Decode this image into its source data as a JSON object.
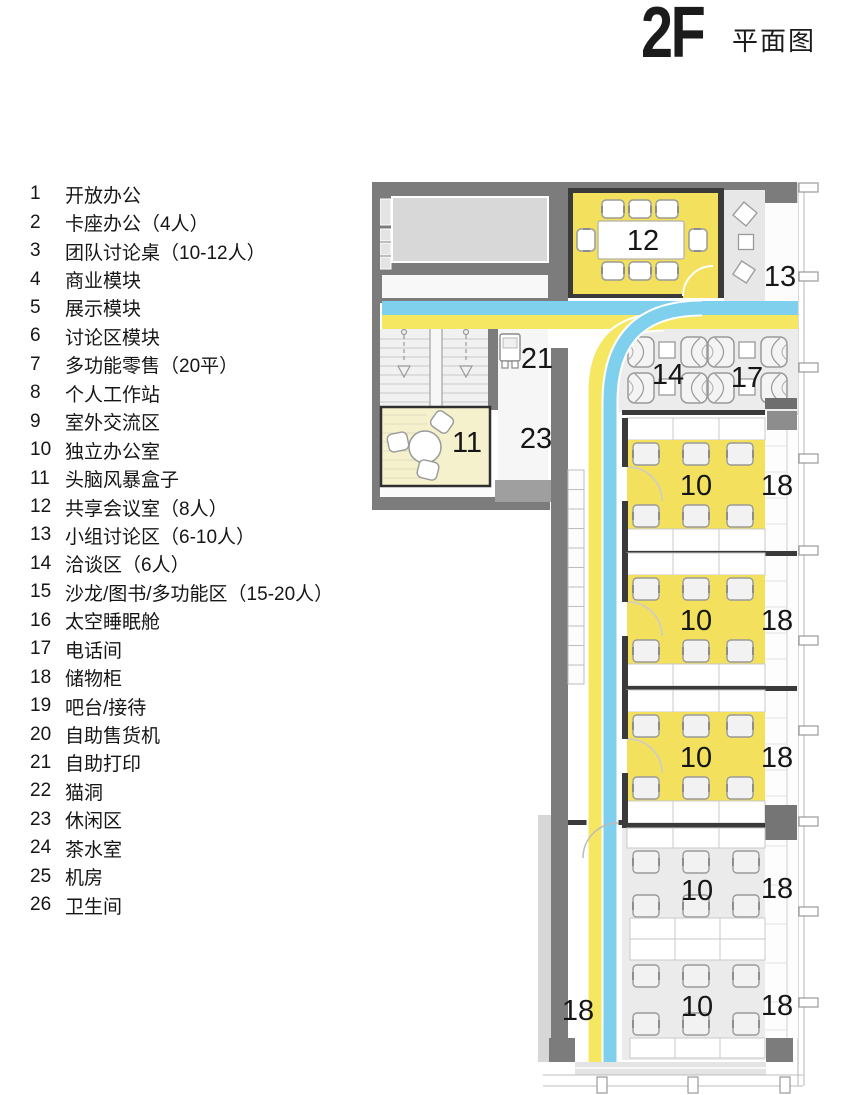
{
  "title": {
    "floor": "2F",
    "name": "平面图"
  },
  "legend": {
    "items": [
      {
        "num": "1",
        "label": "开放办公"
      },
      {
        "num": "2",
        "label": "卡座办公（4人）"
      },
      {
        "num": "3",
        "label": "团队讨论桌（10-12人）"
      },
      {
        "num": "4",
        "label": "商业模块"
      },
      {
        "num": "5",
        "label": "展示模块"
      },
      {
        "num": "6",
        "label": "讨论区模块"
      },
      {
        "num": "7",
        "label": "多功能零售（20平）"
      },
      {
        "num": "8",
        "label": "个人工作站"
      },
      {
        "num": "9",
        "label": "室外交流区"
      },
      {
        "num": "10",
        "label": "独立办公室"
      },
      {
        "num": "11",
        "label": "头脑风暴盒子"
      },
      {
        "num": "12",
        "label": "共享会议室（8人）"
      },
      {
        "num": "13",
        "label": "小组讨论区（6-10人）"
      },
      {
        "num": "14",
        "label": "洽谈区（6人）"
      },
      {
        "num": "15",
        "label": "沙龙/图书/多功能区（15-20人）"
      },
      {
        "num": "16",
        "label": "太空睡眠舱"
      },
      {
        "num": "17",
        "label": "电话间"
      },
      {
        "num": "18",
        "label": "储物柜"
      },
      {
        "num": "19",
        "label": "吧台/接待"
      },
      {
        "num": "20",
        "label": "自助售货机"
      },
      {
        "num": "21",
        "label": "自助打印"
      },
      {
        "num": "22",
        "label": "猫洞"
      },
      {
        "num": "23",
        "label": "休闲区"
      },
      {
        "num": "24",
        "label": "茶水室"
      },
      {
        "num": "25",
        "label": "机房"
      },
      {
        "num": "26",
        "label": "卫生间"
      }
    ]
  },
  "plan": {
    "labels": {
      "meeting_room": "12",
      "group_discussion": "13",
      "negotiation": "14",
      "phone_booth": "17",
      "brainstorm_box": "11",
      "self_print": "21",
      "lounge": "23",
      "private_office": "10",
      "locker": "18"
    },
    "colors": {
      "wall_grey": "#7c7c7c",
      "wall_black": "#3a3a3a",
      "floor_light_grey": "#ececec",
      "room_grey": "#d8d8d8",
      "office_yellow": "#f3e05c",
      "path_yellow": "#f6e763",
      "path_blue": "#7ed0ec",
      "brainstorm_pale_yellow": "#f5f1cd"
    }
  }
}
